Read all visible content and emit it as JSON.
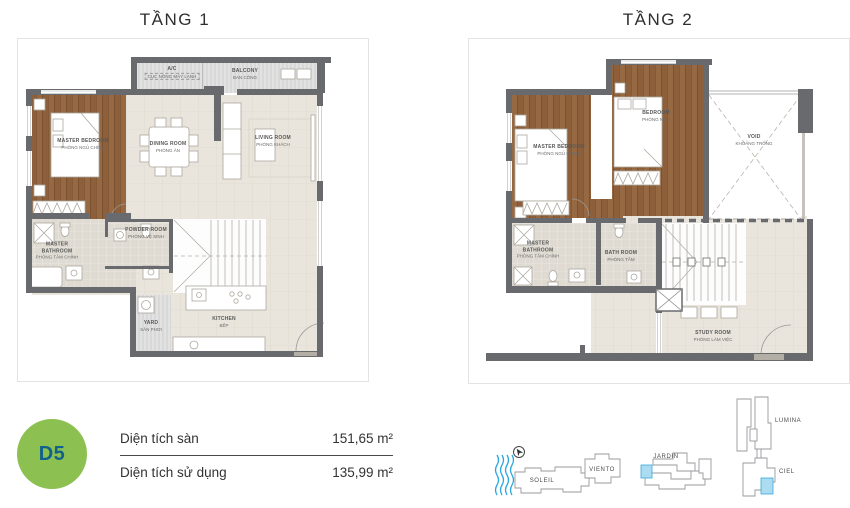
{
  "floor1": {
    "title": "TẦNG 1",
    "labels": {
      "ac": {
        "name": "A/C",
        "sub": "CỤC NÓNG MÁY LẠNH"
      },
      "balcony": {
        "name": "BALCONY",
        "sub": "BAN CÔNG"
      },
      "master_bedroom": {
        "name": "MASTER BEDROOM",
        "sub": "PHÒNG NGỦ CHÍNH"
      },
      "dining": {
        "name": "DINING ROOM",
        "sub": "PHÒNG ĂN"
      },
      "living": {
        "name": "LIVING ROOM",
        "sub": "PHÒNG KHÁCH"
      },
      "powder": {
        "name": "POWDER ROOM",
        "sub": "PHÒNG VỆ SINH"
      },
      "master_bath": {
        "name": "MASTER BATHROOM",
        "sub": "PHÒNG TẮM CHÍNH"
      },
      "yard": {
        "name": "YARD",
        "sub": "SÂN PHƠI"
      },
      "kitchen": {
        "name": "KITCHEN",
        "sub": "BẾP"
      }
    }
  },
  "floor2": {
    "title": "TẦNG 2",
    "labels": {
      "master_bedroom": {
        "name": "MASTER BEDROOM",
        "sub": "PHÒNG NGỦ CHÍNH"
      },
      "bedroom": {
        "name": "BEDROOM",
        "sub": "PHÒNG NGỦ"
      },
      "void": {
        "name": "VOID",
        "sub": "KHOẢNG TRỐNG"
      },
      "master_bath": {
        "name": "MASTER BATHROOM",
        "sub": "PHÒNG TẮM CHÍNH"
      },
      "bath": {
        "name": "BATH ROOM",
        "sub": "PHÒNG TẮM"
      },
      "study": {
        "name": "STUDY ROOM",
        "sub": "PHÒNG LÀM VIỆC"
      }
    }
  },
  "legend": {
    "unit_code": "D5",
    "rows": [
      {
        "label": "Diện tích sàn",
        "value": "151,65 m²"
      },
      {
        "label": "Diện tích sử dụng",
        "value": "135,99 m²"
      }
    ]
  },
  "sitemap": {
    "buildings": {
      "soleil": "SOLEIL",
      "viento": "VIENTO",
      "jardin": "JARDIN",
      "lumina": "LUMINA",
      "ciel": "CIEL"
    }
  },
  "colors": {
    "accent_green": "#8cc152",
    "unit_code_text": "#10618c",
    "water_blue": "#29a8df",
    "highlight_blue": "#abdcf2",
    "wall_gray": "#696a6d",
    "wood_brown": "#8d5f3a"
  }
}
